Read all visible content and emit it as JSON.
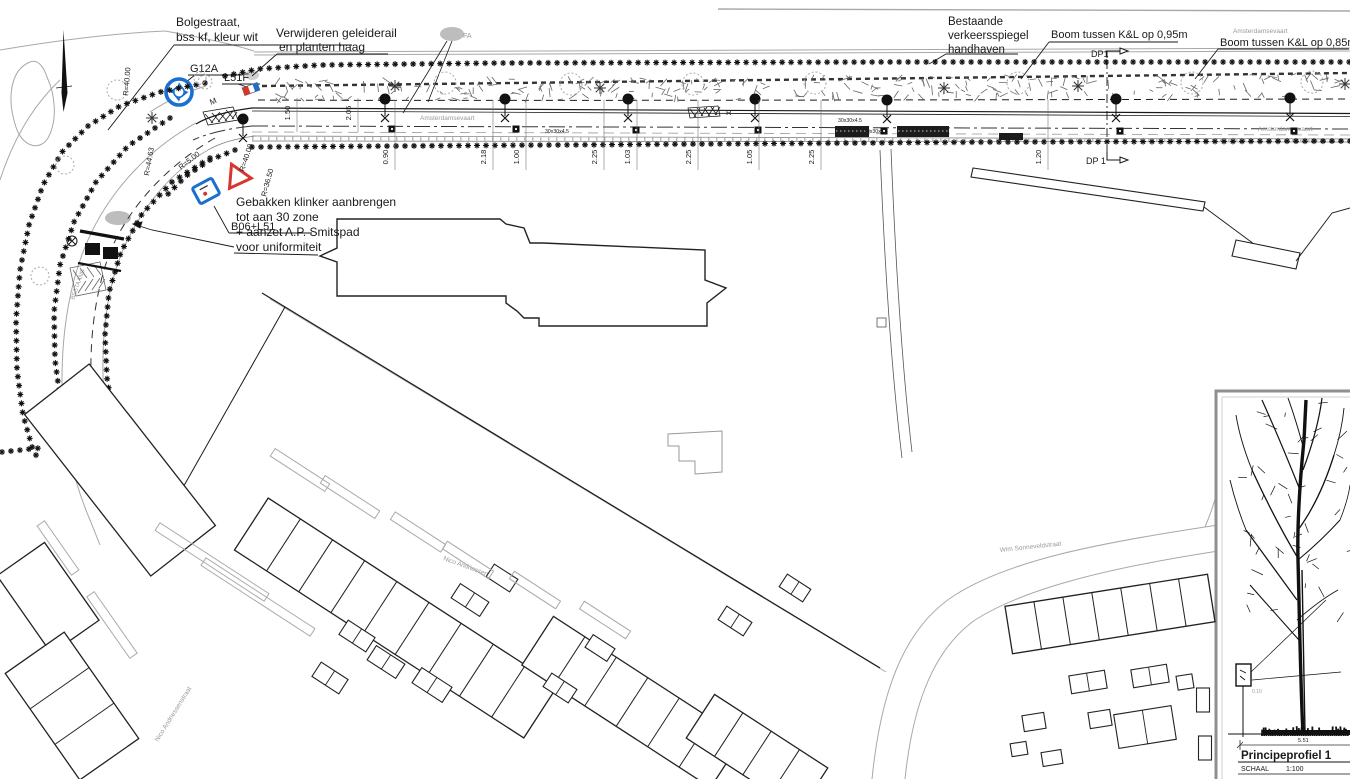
{
  "labels": {
    "bolgestraat1": "Bolgestraat,",
    "bolgestraat2": "bss kf, kleur wit",
    "verwijderen1": "Verwijderen geleiderail",
    "verwijderen2": "en planten haag",
    "g12a": "G12A",
    "l51f": "L51F",
    "b06_l51": "B06+L51",
    "gebakken": [
      "Gebakken klinker aanbrengen",
      "tot aan 30 zone",
      "+ aanzet A.P. Smitspad",
      "voor uniformiteit"
    ],
    "spiegel": [
      "Bestaande",
      "verkeersspiegel",
      "handhaven"
    ],
    "boom095": "Boom tussen K&L op 0,95m",
    "boom085": "Boom tussen K&L op 0,85m",
    "dp_top": "DP1",
    "dp_bottom": "DP 1",
    "m_marking": "M",
    "r_marking": "R",
    "fa": "FA",
    "bestaand": "BESTAAND"
  },
  "streets": {
    "amsterdamsevaart": "Amsterdamsevaart",
    "wim": "Wim Sonneveldstraat",
    "nico": "Nico Andriessenstraat"
  },
  "dims_lower": [
    "0.90",
    "2.18",
    "1.00",
    "2.25",
    "1.03",
    "2.25",
    "1.05",
    "2.25",
    "1.20"
  ],
  "dims_upper": [
    "1.50",
    "2.05"
  ],
  "radii": [
    "R=5.00",
    "R=40.00",
    "R=36.50",
    "R=44.63",
    "R=40.00"
  ],
  "tile": "30x30x4.5",
  "inset": {
    "title": "Principeprofiel 1",
    "schaal_label": "SCHAAL",
    "schaal_value": "1:100",
    "width_dim": "5.51",
    "post_offset": "0.10"
  },
  "colors": {
    "ink": "#1a1a1a",
    "line_gray": "#a8a8a8",
    "sign_blue": "#1a6fd0",
    "sign_red": "#d6362f"
  }
}
